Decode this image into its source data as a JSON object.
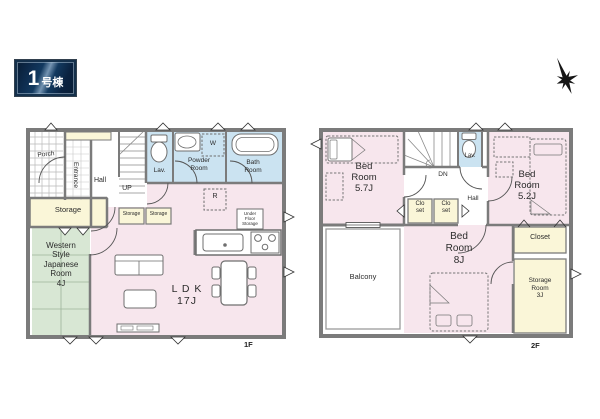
{
  "badge": {
    "number": "1",
    "suffix": "号棟"
  },
  "compass_icon": "north-compass-star",
  "colors": {
    "room_pink": "#f7e6ed",
    "room_blue": "#cbe3f1",
    "room_yellow": "#faf6d8",
    "room_green": "#d8e7d4",
    "wall_gray": "#7b7b7b",
    "badge_navy": "#0e2d50"
  },
  "floor1": {
    "floor_label": "1F",
    "rooms": {
      "porch": "Porch",
      "entrance": "Entrance",
      "hall": "Hall",
      "stairs": "UP",
      "lav": "Lav.",
      "powder_room": "Powder\nRoom",
      "bath_room": "Bath\nRoom",
      "storage": "Storage",
      "storage_small_1": "Storage",
      "storage_small_2": "Storage",
      "japanese_room": "Western\nStyle\nJapanese\nRoom\n4J",
      "ldk": "L D K\n17J",
      "refrigerator": "R",
      "washer": "W",
      "under_floor_storage": "Under\nFloor\nStorage"
    }
  },
  "floor2": {
    "floor_label": "2F",
    "rooms": {
      "bedroom_57": "Bed\nRoom\n5.7J",
      "stairs": "DN",
      "lav": "Lav.",
      "hall": "Hall",
      "closet_small_1": "Clo\nset",
      "closet_small_2": "Clo\nset",
      "bedroom_52": "Bed\nRoom\n5.2J",
      "balcony": "Balcony",
      "bedroom_8": "Bed\nRoom\n8J",
      "closet": "Closet",
      "storage_room": "Storage\nRoom\n3J"
    }
  }
}
